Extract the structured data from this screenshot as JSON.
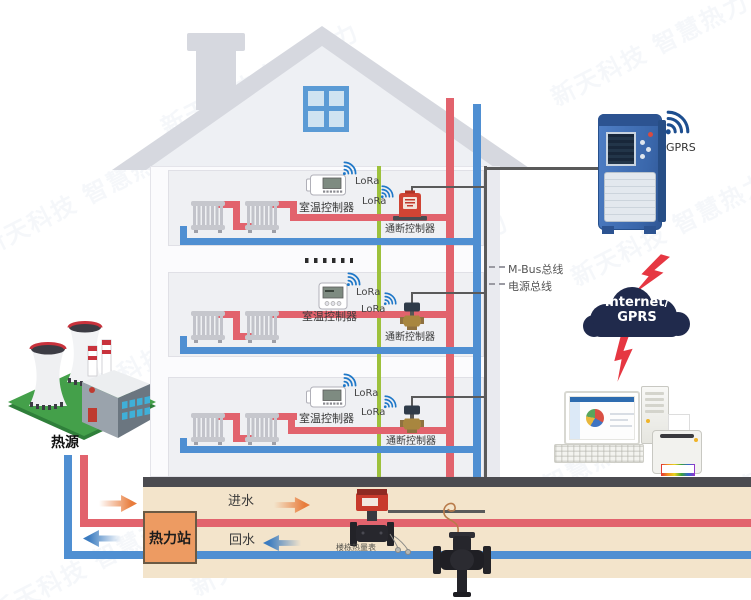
{
  "watermark": {
    "text": "新天科技 智慧热力"
  },
  "building": {
    "floors": [
      {
        "thermostat": "室温控制器",
        "thermostat_radio": "LoRa",
        "valve": "通断控制器",
        "valve_radio": "LoRa"
      },
      {
        "thermostat": "室温控制器",
        "thermostat_radio": "LoRa",
        "valve": "通断控制器",
        "valve_radio": "LoRa"
      },
      {
        "thermostat": "室温控制器",
        "thermostat_radio": "LoRa",
        "valve": "通断控制器",
        "valve_radio": "LoRa"
      }
    ],
    "bus_labels": {
      "mbus": "M-Bus总线",
      "power": "电源总线"
    }
  },
  "concentrator": {
    "radio": "GPRS"
  },
  "network": {
    "cloud_line1": "Internet/",
    "cloud_line2": "GPRS"
  },
  "heat_source": {
    "label": "热源"
  },
  "heat_station": {
    "label": "热力站"
  },
  "underground": {
    "supply": "进水",
    "return": "回水",
    "meter": "楼栋热量表"
  },
  "colors": {
    "supply": "#e2636d",
    "return": "#4f8fd2",
    "power": "#9dc13c",
    "bus": "#5a5a5a",
    "cloud": "#202a4c",
    "lightning": "#e63742",
    "station": "#ed9b62",
    "soil": "#f3e4cb",
    "ground": "#4b4b50",
    "lora": "#1f78c8"
  }
}
